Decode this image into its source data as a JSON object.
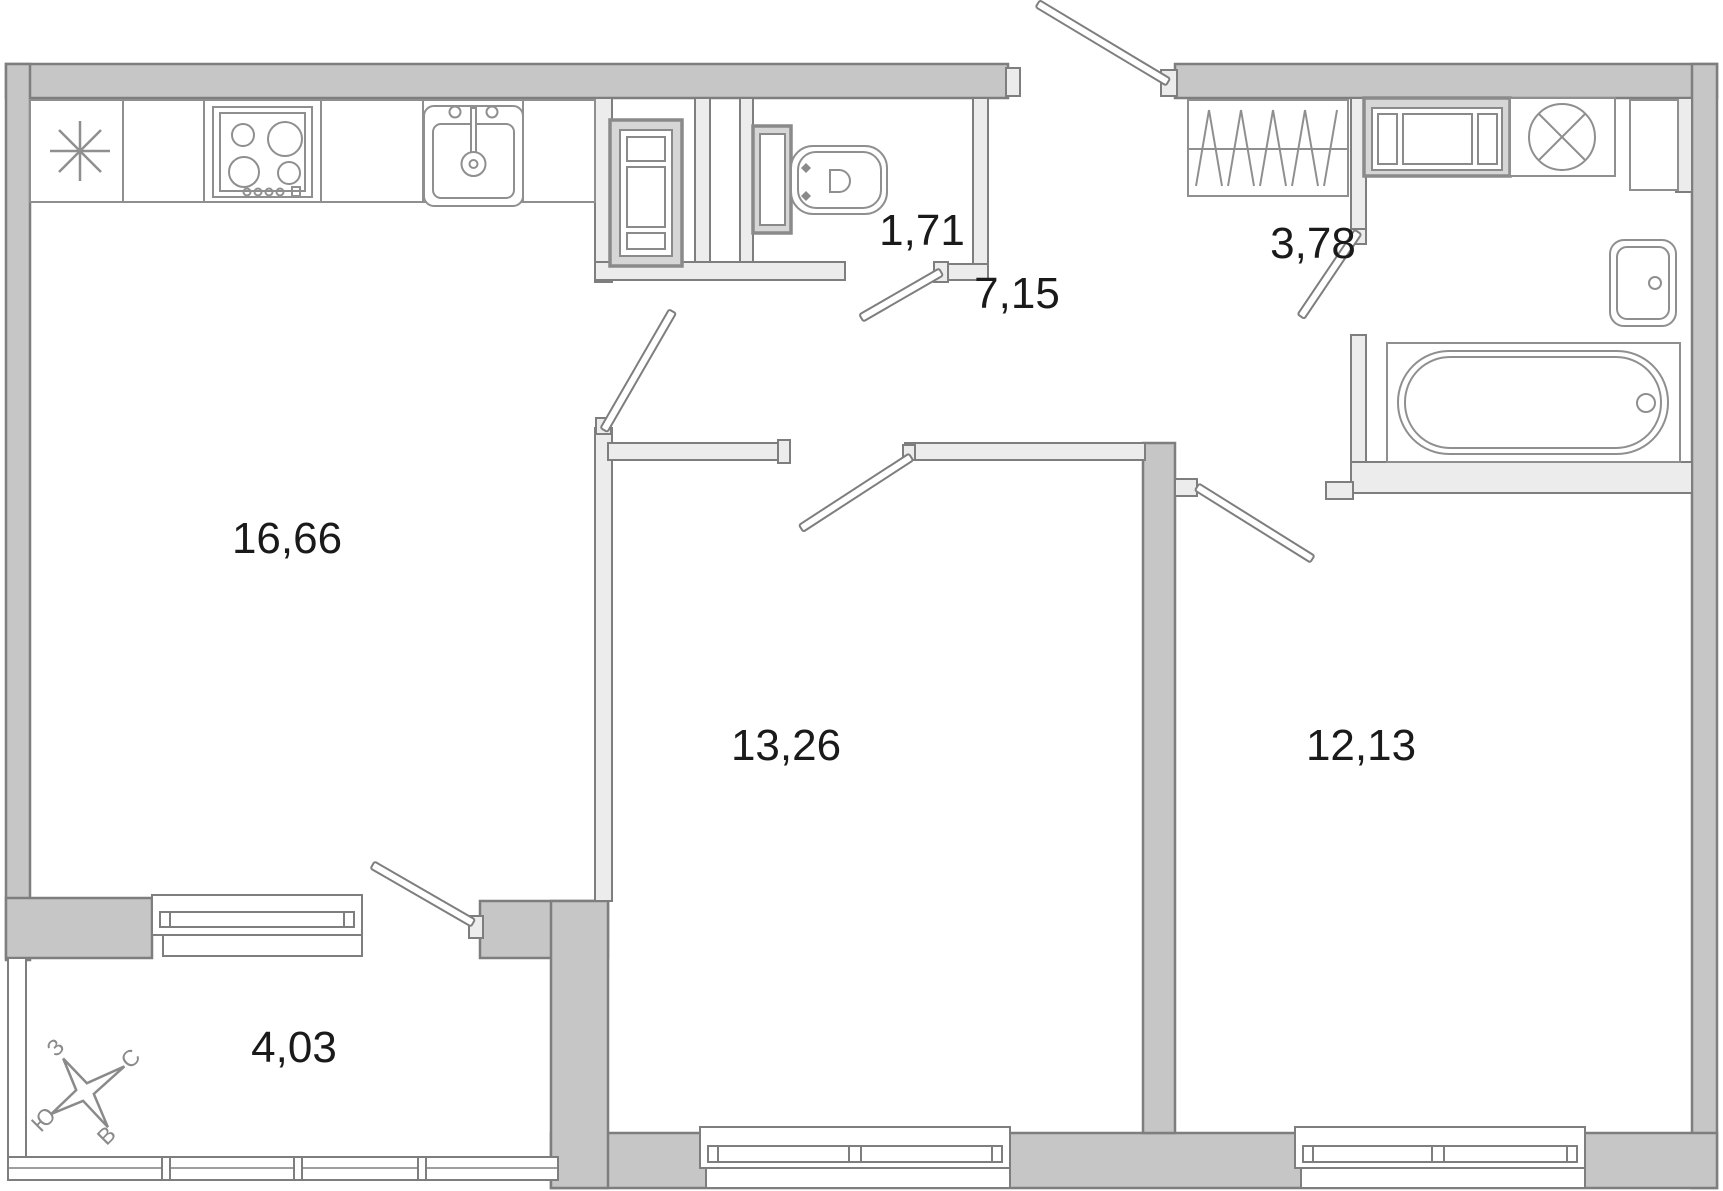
{
  "rooms": {
    "living_kitchen": {
      "area": "16,66"
    },
    "wc": {
      "area": "1,71"
    },
    "hallway": {
      "area": "7,15"
    },
    "bathroom": {
      "area": "3,78"
    },
    "bedroom_1": {
      "area": "13,26"
    },
    "bedroom_2": {
      "area": "12,13"
    },
    "balcony": {
      "area": "4,03"
    }
  },
  "compass": {
    "north": "С",
    "south": "Ю",
    "west": "З",
    "east": "В"
  },
  "icons": {
    "kitchen_star": "kitchen-star-icon",
    "stove": "stove-icon",
    "kitchen_sink": "kitchen-sink-icon",
    "vent_shaft": "vent-shaft-icon",
    "toilet": "toilet-icon",
    "wardrobe": "wardrobe-icon",
    "washing_machine": "washing-machine-icon",
    "bathroom_sink": "bathroom-sink-icon",
    "bathtub": "bathtub-icon",
    "compass_rose": "compass-rose-icon"
  },
  "colors": {
    "bearing_wall": "#c6c6c6",
    "partition_wall": "#ececec",
    "outline": "#7e7e7e",
    "fixture": "#8f8f8f",
    "label": "#1a1a1a",
    "background": "#ffffff"
  }
}
